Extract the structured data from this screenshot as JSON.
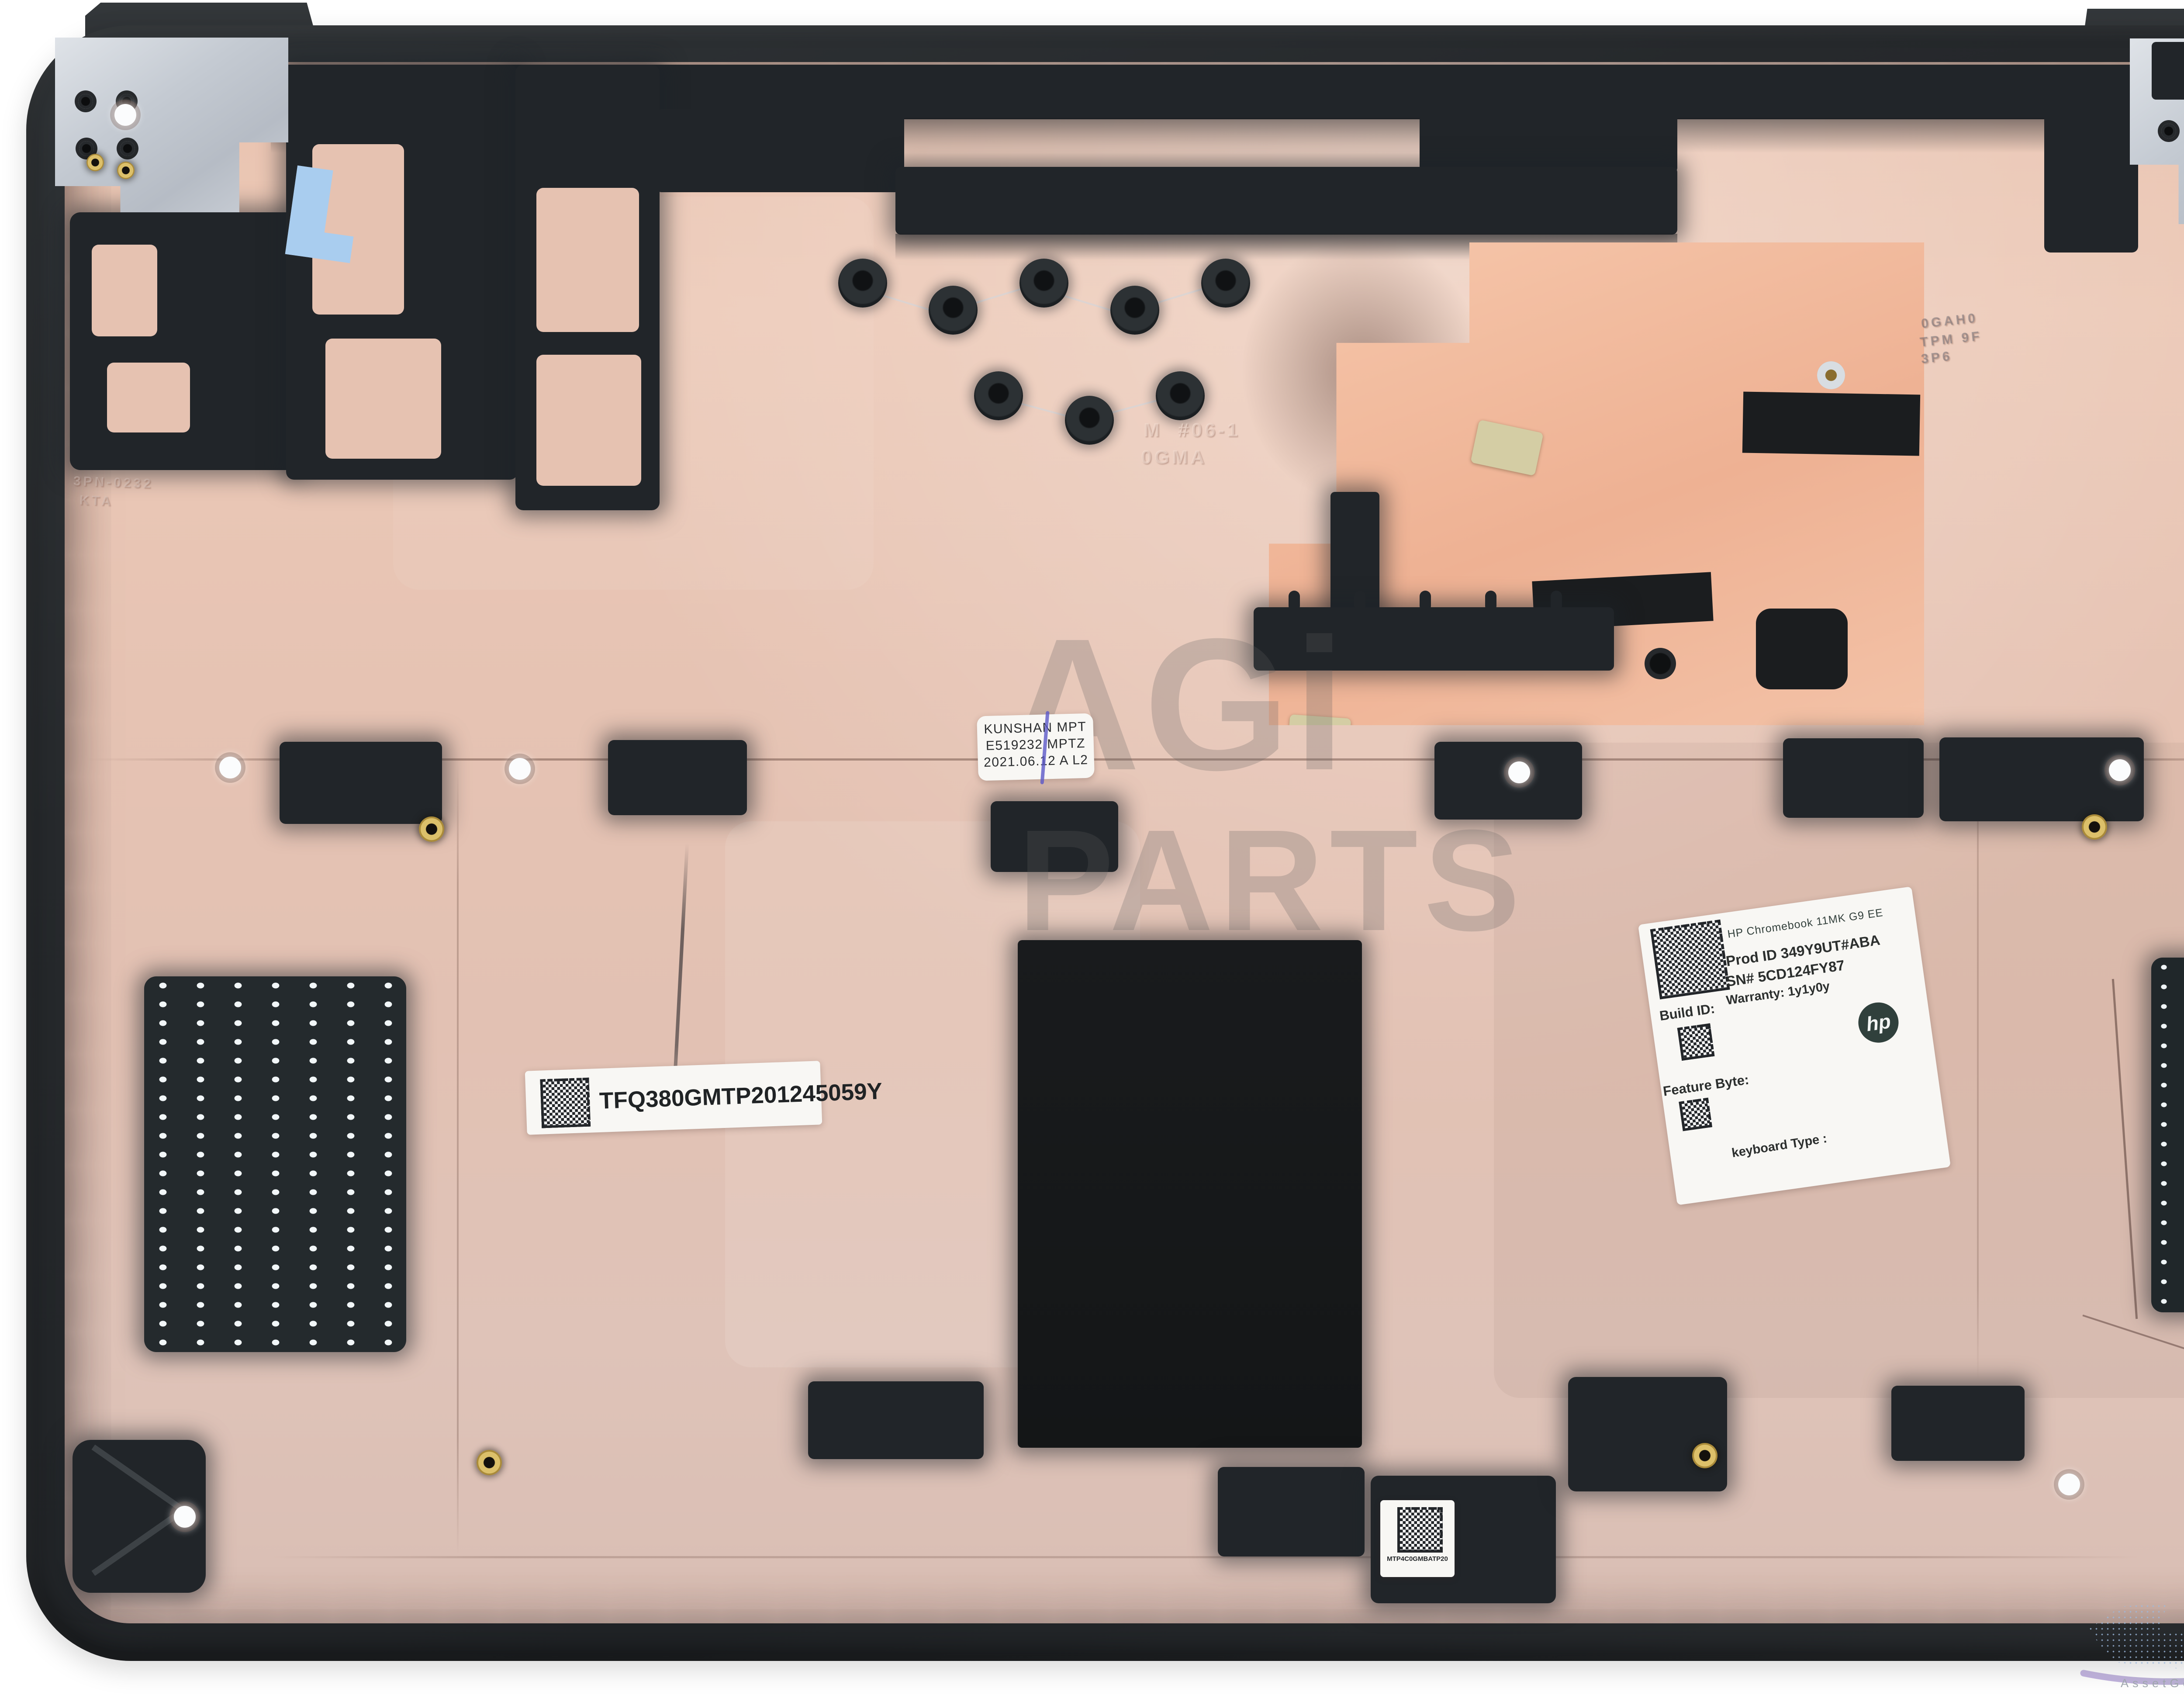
{
  "scene": {
    "description": "HP Chromebook 11MK G9 EE bottom case (interior view) product photo"
  },
  "watermark": {
    "line1": "AGi",
    "line2": "PARTS"
  },
  "mold_marks": {
    "center_line1": "M #06-1",
    "center_line2": "0GMA",
    "left_line1": "3PN-0232",
    "left_line2": "KTA",
    "right_line1": "0GAH0",
    "right_line2": "TPM 9F",
    "right_line3": "3P6"
  },
  "labels": {
    "factory": {
      "line1": "KUNSHAN MPT",
      "line2": "E519232 MPTZ",
      "line3": "2021.06.12 A L2"
    },
    "serial_barcode": {
      "text": "TFQ380GMTP201245059Y"
    },
    "product": {
      "model": "HP Chromebook 11MK G9 EE",
      "prod_id": "Prod ID 349Y9UT#ABA",
      "serial": "SN# 5CD124FY87",
      "warranty": "Warranty: 1y1y0y",
      "build_id_label": "Build ID:",
      "feature_byte_label": "Feature Byte:",
      "keyboard_type_label": "keyboard Type :",
      "hp_logo": "hp"
    },
    "board_code": {
      "text": "MTP4C0GMBATP20"
    }
  },
  "brand": {
    "logo": "AGI",
    "tagline": "AssetGenie Incorporated"
  },
  "colors": {
    "case": "#26292c",
    "pink": "#e6c2b1",
    "copper": "#f2c0a5",
    "silver": "#c9ced6",
    "label": "#f8f7f4",
    "pen": "#5b57c8",
    "brass": "#d3b25c",
    "tape": "#a9cdef",
    "logo-gray": "#8d949b",
    "logo-blue": "#7fcdf2",
    "map-blue": "#9db9dd"
  }
}
